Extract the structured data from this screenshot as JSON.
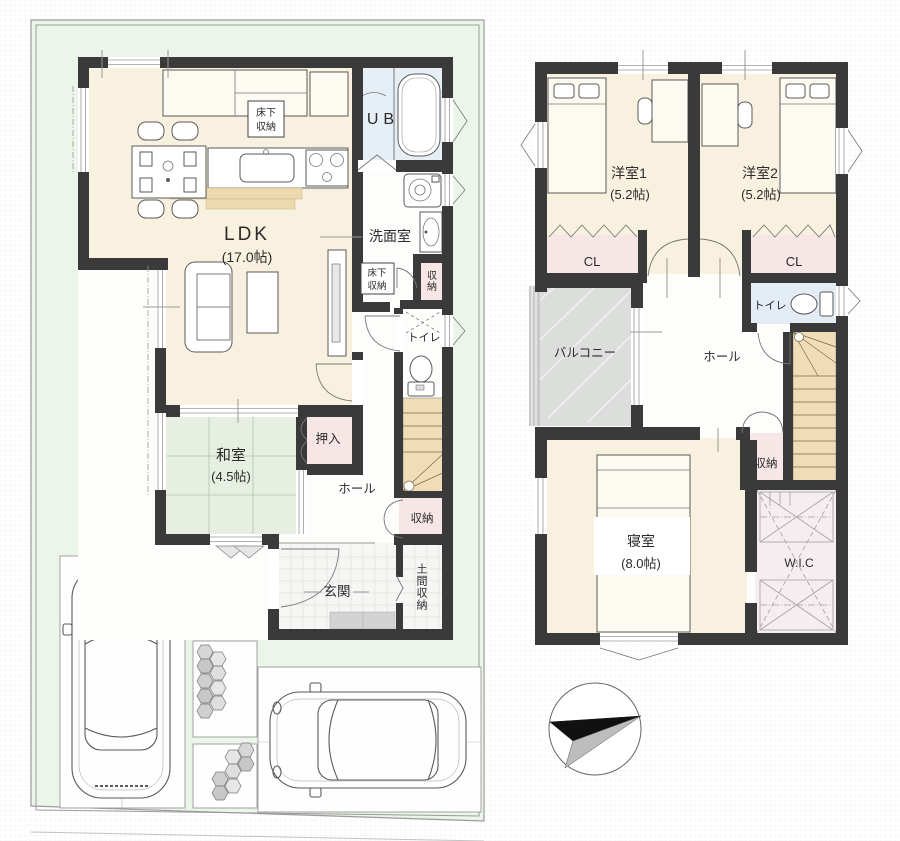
{
  "colors": {
    "wall": "#3a3a3a",
    "floor": "#f9f1df",
    "tatami": "#e6efe2",
    "closet": "#f7e6e6",
    "wic": "#f6edf0",
    "stairs": "#f0ddb8",
    "bath": "#e7eff6",
    "toilet2": "#e3ecf5",
    "balcony": "#dcdedc",
    "plot": "#ecf5e9",
    "porch": "#d3d3d3",
    "label": "#2b2b2b"
  },
  "floor1": {
    "ldk": "LDK",
    "ldk_size": "(17.0帖)",
    "washitsu": "和室",
    "washitsu_size": "(4.5帖)",
    "ub": "UB",
    "senmen": "洗面室",
    "yukashita1_l1": "床下",
    "yukashita1_l2": "収納",
    "yukashita2_l1": "床下",
    "yukashita2_l2": "収納",
    "shuno_mid": "収納",
    "toilet": "トイレ",
    "oshiire": "押入",
    "hall": "ホール",
    "shuno": "収納",
    "genkan": "玄関",
    "doma": "土間収納"
  },
  "floor2": {
    "yoshitsu1": "洋室1",
    "yoshitsu1_size": "(5.2帖)",
    "yoshitsu2": "洋室2",
    "yoshitsu2_size": "(5.2帖)",
    "cl1": "CL",
    "cl2": "CL",
    "balcony": "バルコニー",
    "hall": "ホール",
    "toilet": "トイレ",
    "shuno": "収納",
    "shinshitsu": "寝室",
    "shinshitsu_size": "(8.0帖)",
    "wic": "W.I.C"
  }
}
